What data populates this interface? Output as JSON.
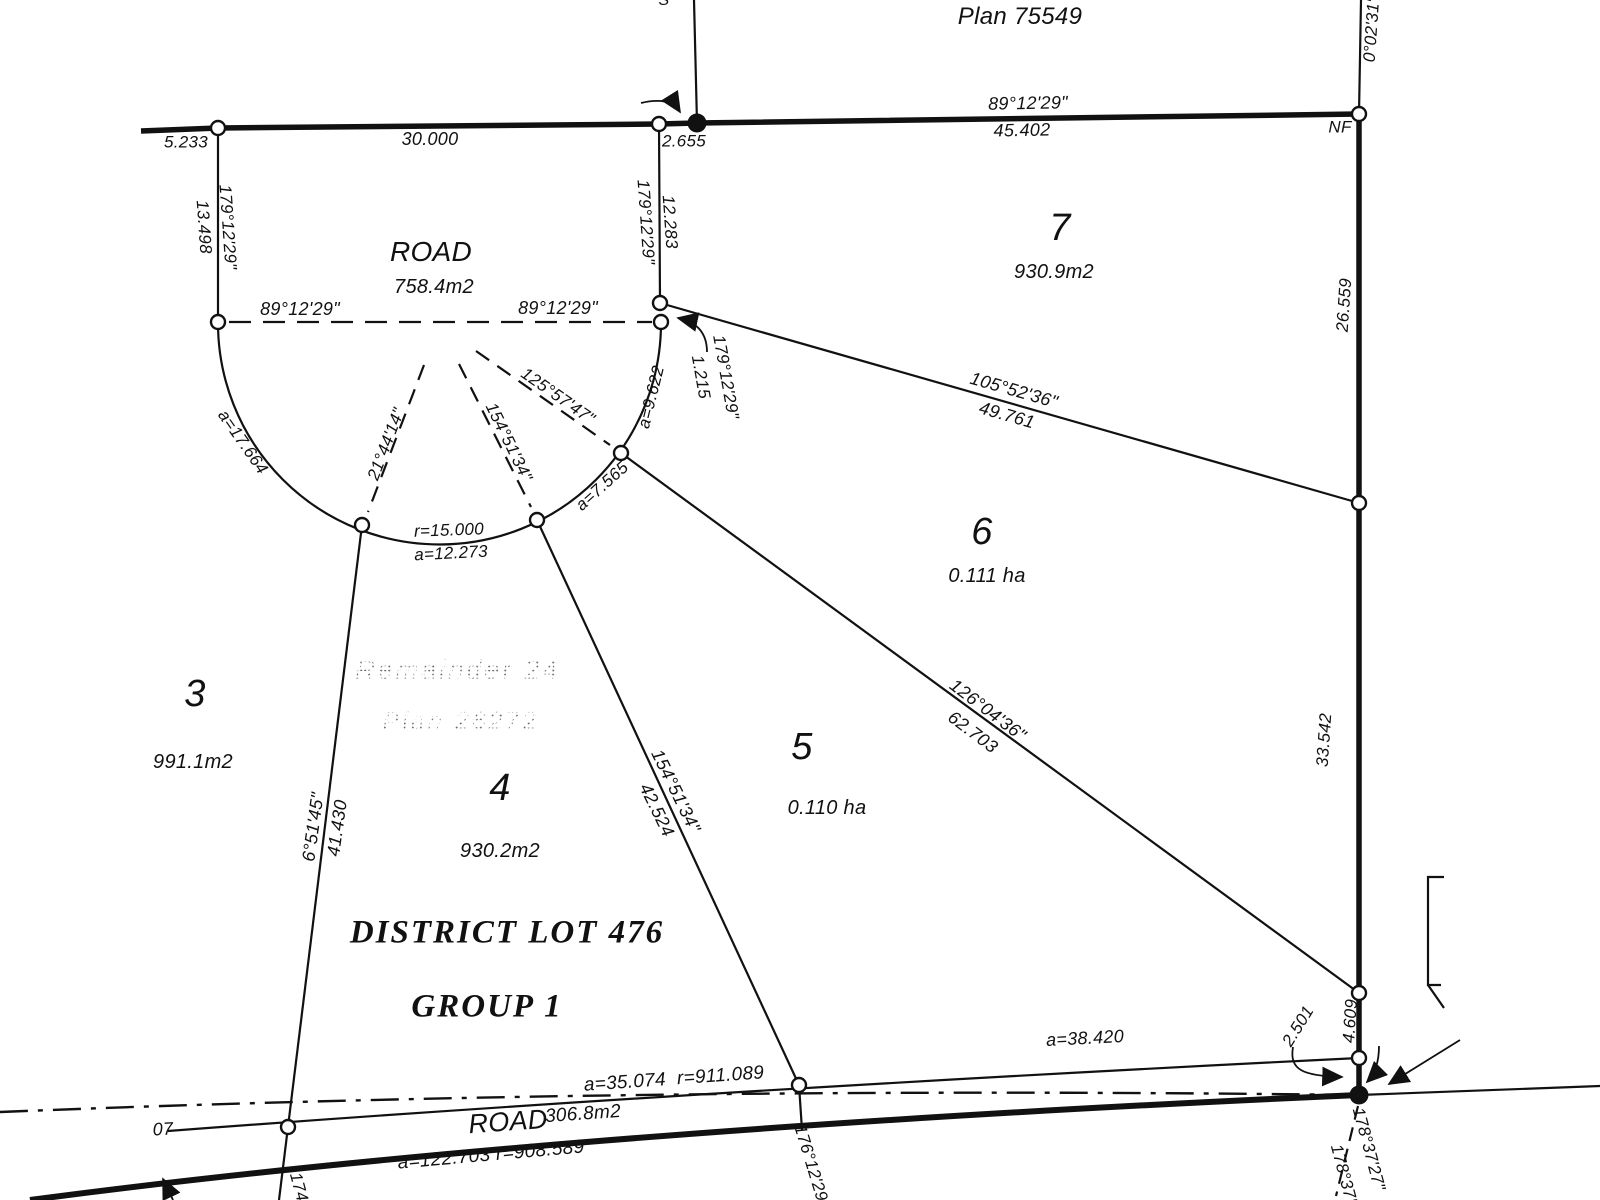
{
  "colors": {
    "ink": "#111111",
    "faded_text": "#8d8d8d",
    "paper": "#ffffff"
  },
  "header": {
    "adjacent_plan": "Plan 75549",
    "partial_glyph": "S",
    "monument_nf": "NF",
    "east_bearing_up": "0°02'31\" 1"
  },
  "north_boundary": {
    "bearing": "89°12'29\"",
    "seg1": "5.233",
    "seg2": "30.000",
    "seg3": "2.655",
    "seg4": "45.402"
  },
  "west_stub": {
    "length": "13.498",
    "bearing": "179°12'29\""
  },
  "center_stub": {
    "bearing": "179°12'29\"",
    "length": "12.283"
  },
  "east_boundary": {
    "seg1": "26.559",
    "seg2": "33.542",
    "seg3": "4.609",
    "seg4": "2.501",
    "bearing1": "178°37'27\"",
    "bearing2": "178°37'1"
  },
  "road_bulb": {
    "name": "ROAD",
    "area": "758.4m2",
    "bearing_left": "89°12'29\"",
    "bearing_right": "89°12'29\"",
    "radial1": "21°44'14\"",
    "radial2": "154°51'34\"",
    "radial3": "125°57'47\"",
    "arc_left": "a=17.664",
    "radius": "r=15.000",
    "arc_bottom": "a=12.273",
    "arc_right": "a=7.565",
    "arc_upper": "a=9.622",
    "tie": "1.215",
    "tie_bearing": "179°12'29\""
  },
  "lot_lines": {
    "lot7": {
      "bearing": "105°52'36\"",
      "distance": "49.761"
    },
    "lot6": {
      "bearing": "126°04'36\"",
      "distance": "62.703"
    },
    "lot5": {
      "bearing": "154°51'34\"",
      "distance": "42.524"
    },
    "lot4": {
      "bearing": "6°51'45\"",
      "distance": "41.430"
    },
    "lot5_south": {
      "bearing": "176°12'29\""
    },
    "lot4_south": {
      "bearing": "174"
    }
  },
  "lots": [
    {
      "number": "7",
      "area": "930.9m2"
    },
    {
      "number": "6",
      "area": "0.111 ha"
    },
    {
      "number": "5",
      "area": "0.110 ha"
    },
    {
      "number": "4",
      "area": "930.2m2"
    },
    {
      "number": "3",
      "area": "991.1m2"
    }
  ],
  "remainder": {
    "line1": "Remainder 24",
    "line2": "Plan 26272"
  },
  "district": {
    "line1": "DISTRICT LOT 476",
    "line2": "GROUP 1"
  },
  "south_road": {
    "name": "ROAD",
    "area": "306.8m2",
    "arc_north": "a=35.074  r=911.089",
    "arc_south": "a=122.703 r=908.589",
    "arc_east": "a=38.420",
    "partial_west": "07"
  }
}
